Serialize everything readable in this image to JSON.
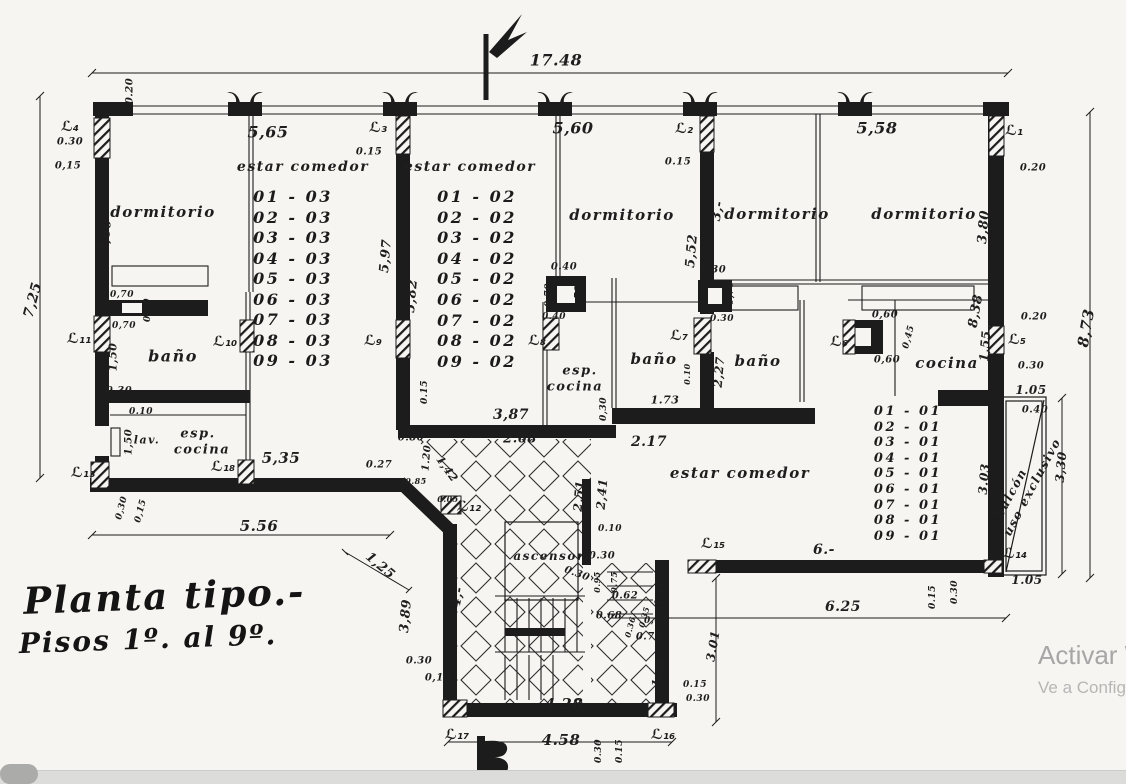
{
  "colors": {
    "ink": "#1c1c1c",
    "paper": "#f6f5f1",
    "watermark_line1": "#a6a6a6",
    "watermark_line2": "#b6b6b6",
    "strip": "#dcdcda",
    "pill": "#ababa9"
  },
  "title": {
    "line1": "Planta tipo.-",
    "line2": "Pisos 1º. al 9º."
  },
  "watermark": {
    "line1": "Activar W",
    "line2": "Ve a Config"
  },
  "unit_lists": [
    {
      "n": "unit-list-apt3",
      "x": 293,
      "top": 187,
      "lh": 20.5,
      "s": 16,
      "items": [
        "01 - 03",
        "02 - 03",
        "03 - 03",
        "04 - 03",
        "05 - 03",
        "06 - 03",
        "07 - 03",
        "08 - 03",
        "09 - 03"
      ]
    },
    {
      "n": "unit-list-apt2",
      "x": 477,
      "top": 187,
      "lh": 20.6,
      "s": 16,
      "items": [
        "01 - 02",
        "02 - 02",
        "03 - 02",
        "04 - 02",
        "05 - 02",
        "06 - 02",
        "07 - 02",
        "08 - 02",
        "09 - 02"
      ]
    },
    {
      "n": "unit-list-apt1",
      "x": 908,
      "top": 404,
      "lh": 15.6,
      "s": 13,
      "items": [
        "01 - 01",
        "02 - 01",
        "03 - 01",
        "04 - 01",
        "05 - 01",
        "06 - 01",
        "07 - 01",
        "08 - 01",
        "09 - 01"
      ]
    }
  ],
  "labels": [
    {
      "n": "room-dormitorio-apt3",
      "t": "dormitorio",
      "x": 163,
      "y": 212,
      "s": 15,
      "k": "room"
    },
    {
      "n": "room-estar-comedor-apt3",
      "t": "estar comedor",
      "x": 303,
      "y": 167,
      "s": 14,
      "k": "room"
    },
    {
      "n": "room-estar-comedor-apt2",
      "t": "estar comedor",
      "x": 470,
      "y": 167,
      "s": 14,
      "k": "room"
    },
    {
      "n": "room-dormitorio-apt2",
      "t": "dormitorio",
      "x": 622,
      "y": 215,
      "s": 15,
      "k": "room"
    },
    {
      "n": "room-dormitorio-apt1-a",
      "t": "dormitorio",
      "x": 777,
      "y": 214,
      "s": 15,
      "k": "room"
    },
    {
      "n": "room-dormitorio-apt1-b",
      "t": "dormitorio",
      "x": 924,
      "y": 214,
      "s": 15,
      "k": "room"
    },
    {
      "n": "room-bano-apt3",
      "t": "baño",
      "x": 173,
      "y": 356,
      "s": 16,
      "k": "room"
    },
    {
      "n": "room-bano-apt1-a",
      "t": "baño",
      "x": 654,
      "y": 359,
      "s": 15,
      "k": "room"
    },
    {
      "n": "room-bano-apt1-b",
      "t": "baño",
      "x": 758,
      "y": 361,
      "s": 15,
      "k": "room"
    },
    {
      "n": "room-cocina-apt1",
      "t": "cocina",
      "x": 947,
      "y": 363,
      "s": 15,
      "k": "room"
    },
    {
      "n": "room-esp-apt3",
      "t": "esp.",
      "x": 198,
      "y": 434,
      "s": 13,
      "k": "room"
    },
    {
      "n": "room-cocina-apt3",
      "t": "cocina",
      "x": 202,
      "y": 450,
      "s": 13,
      "k": "room"
    },
    {
      "n": "label-lav",
      "t": "lav.",
      "x": 147,
      "y": 440,
      "s": 11,
      "k": "room"
    },
    {
      "n": "room-esp-apt2",
      "t": "esp.",
      "x": 580,
      "y": 371,
      "s": 13,
      "k": "room"
    },
    {
      "n": "room-cocina-apt2",
      "t": "cocina",
      "x": 575,
      "y": 387,
      "s": 13,
      "k": "room"
    },
    {
      "n": "room-estar-comedor-apt1",
      "t": "estar comedor",
      "x": 740,
      "y": 473,
      "s": 15,
      "k": "room"
    },
    {
      "n": "room-ascensor",
      "t": "ascensor",
      "x": 549,
      "y": 556,
      "s": 12,
      "k": "room"
    },
    {
      "n": "room-balcon",
      "t": "balcón",
      "x": 1011,
      "y": 493,
      "s": 12,
      "k": "room",
      "r": -62
    },
    {
      "n": "room-uso-exclusivo",
      "t": "uso exclusivo",
      "x": 1032,
      "y": 487,
      "s": 12,
      "k": "room",
      "r": -62
    },
    {
      "n": "wall-label-l1",
      "t": "ℒ₁",
      "x": 1014,
      "y": 131,
      "s": 14,
      "k": "wall"
    },
    {
      "n": "wall-label-l2",
      "t": "ℒ₂",
      "x": 684,
      "y": 129,
      "s": 14,
      "k": "wall"
    },
    {
      "n": "wall-label-l3",
      "t": "ℒ₃",
      "x": 378,
      "y": 128,
      "s": 14,
      "k": "wall"
    },
    {
      "n": "wall-label-l4",
      "t": "ℒ₄",
      "x": 70,
      "y": 127,
      "s": 14,
      "k": "wall"
    },
    {
      "n": "wall-label-l5",
      "t": "ℒ₅",
      "x": 1017,
      "y": 340,
      "s": 14,
      "k": "wall"
    },
    {
      "n": "wall-label-l6",
      "t": "ℒ₆",
      "x": 839,
      "y": 342,
      "s": 14,
      "k": "wall"
    },
    {
      "n": "wall-label-l7",
      "t": "ℒ₇",
      "x": 679,
      "y": 336,
      "s": 14,
      "k": "wall"
    },
    {
      "n": "wall-label-l8",
      "t": "ℒ₈",
      "x": 537,
      "y": 341,
      "s": 14,
      "k": "wall"
    },
    {
      "n": "wall-label-l9",
      "t": "ℒ₉",
      "x": 373,
      "y": 341,
      "s": 14,
      "k": "wall"
    },
    {
      "n": "wall-label-l10",
      "t": "ℒ₁₀",
      "x": 225,
      "y": 342,
      "s": 14,
      "k": "wall"
    },
    {
      "n": "wall-label-l11",
      "t": "ℒ₁₁",
      "x": 79,
      "y": 339,
      "s": 14,
      "k": "wall"
    },
    {
      "n": "wall-label-l12",
      "t": "ℒ₁₂",
      "x": 469,
      "y": 507,
      "s": 14,
      "k": "wall"
    },
    {
      "n": "wall-label-l13",
      "t": "ℒ₁₃",
      "x": 83,
      "y": 473,
      "s": 14,
      "k": "wall"
    },
    {
      "n": "wall-label-l14",
      "t": "ℒ₁₄",
      "x": 1015,
      "y": 554,
      "s": 14,
      "k": "wall"
    },
    {
      "n": "wall-label-l15",
      "t": "ℒ₁₅",
      "x": 713,
      "y": 544,
      "s": 14,
      "k": "wall"
    },
    {
      "n": "wall-label-l16",
      "t": "ℒ₁₆",
      "x": 663,
      "y": 735,
      "s": 14,
      "k": "wall"
    },
    {
      "n": "wall-label-l17",
      "t": "ℒ₁₇",
      "x": 457,
      "y": 735,
      "s": 14,
      "k": "wall"
    },
    {
      "n": "wall-label-l18",
      "t": "ℒ₁₈",
      "x": 223,
      "y": 467,
      "s": 14,
      "k": "wall"
    },
    {
      "n": "dim-total-width",
      "t": "17.48",
      "x": 556,
      "y": 60,
      "s": 16
    },
    {
      "n": "dim-5-65",
      "t": "5,65",
      "x": 268,
      "y": 132,
      "s": 16
    },
    {
      "n": "dim-5-60",
      "t": "5,60",
      "x": 573,
      "y": 128,
      "s": 16
    },
    {
      "n": "dim-5-58",
      "t": "5,58",
      "x": 877,
      "y": 128,
      "s": 16
    },
    {
      "n": "dim-7-25",
      "t": "7,25",
      "x": 33,
      "y": 300,
      "s": 14,
      "r": -75
    },
    {
      "n": "dim-8-73",
      "t": "8,73",
      "x": 1086,
      "y": 328,
      "s": 15,
      "r": -80
    },
    {
      "n": "dim-3-60",
      "t": "3,60",
      "x": 106,
      "y": 236,
      "s": 13,
      "r": -85
    },
    {
      "n": "dim-5-97",
      "t": "5,97",
      "x": 386,
      "y": 256,
      "s": 13,
      "r": -85
    },
    {
      "n": "dim-5-82",
      "t": "5,82",
      "x": 412,
      "y": 296,
      "s": 13,
      "r": -85
    },
    {
      "n": "dim-5-52",
      "t": "5,52",
      "x": 692,
      "y": 251,
      "s": 13,
      "r": -85
    },
    {
      "n": "dim-3-dash",
      "t": "3,-",
      "x": 718,
      "y": 211,
      "s": 13,
      "r": -80
    },
    {
      "n": "dim-3-80",
      "t": "3,80",
      "x": 984,
      "y": 227,
      "s": 13,
      "r": -85
    },
    {
      "n": "dim-8-38",
      "t": "8,38",
      "x": 976,
      "y": 311,
      "s": 13,
      "r": -80
    },
    {
      "n": "dim-1-55",
      "t": "1,55",
      "x": 985,
      "y": 346,
      "s": 12,
      "r": -85
    },
    {
      "n": "dim-0-20-a",
      "t": "0.20",
      "x": 130,
      "y": 91,
      "s": 10,
      "r": -90
    },
    {
      "n": "dim-0-20-b",
      "t": "0.20",
      "x": 1033,
      "y": 168,
      "s": 10
    },
    {
      "n": "dim-0-20-c",
      "t": "0.20",
      "x": 1034,
      "y": 317,
      "s": 10
    },
    {
      "n": "dim-0-30-a",
      "t": "0.30",
      "x": 70,
      "y": 142,
      "s": 10
    },
    {
      "n": "dim-0-15-a",
      "t": "0,15",
      "x": 68,
      "y": 166,
      "s": 10
    },
    {
      "n": "dim-0-15-b",
      "t": "0.15",
      "x": 369,
      "y": 152,
      "s": 10
    },
    {
      "n": "dim-0-15-c",
      "t": "0.15",
      "x": 678,
      "y": 162,
      "s": 10
    },
    {
      "n": "dim-0-40-a",
      "t": "0.40",
      "x": 564,
      "y": 267,
      "s": 10
    },
    {
      "n": "dim-0-70-a",
      "t": "0,70",
      "x": 549,
      "y": 295,
      "s": 9,
      "r": -90
    },
    {
      "n": "dim-0-70-b",
      "t": "0,70",
      "x": 579,
      "y": 297,
      "s": 9,
      "r": -90
    },
    {
      "n": "dim-0-30-b",
      "t": "0.30",
      "x": 713,
      "y": 270,
      "s": 10
    },
    {
      "n": "dim-0-70-c",
      "t": "0,70",
      "x": 731,
      "y": 293,
      "s": 9,
      "r": -90
    },
    {
      "n": "dim-0-70-d",
      "t": "0,70",
      "x": 122,
      "y": 295,
      "s": 9
    },
    {
      "n": "dim-0-70-e",
      "t": "0,70",
      "x": 124,
      "y": 326,
      "s": 9
    },
    {
      "n": "dim-0-30-c",
      "t": "0.30",
      "x": 148,
      "y": 310,
      "s": 9,
      "r": -90
    },
    {
      "n": "dim-1-50-a",
      "t": "1,50",
      "x": 113,
      "y": 357,
      "s": 11,
      "r": -90
    },
    {
      "n": "dim-0-30-d",
      "t": "0.30",
      "x": 119,
      "y": 391,
      "s": 10
    },
    {
      "n": "dim-0-10-a",
      "t": "0.10",
      "x": 141,
      "y": 412,
      "s": 9
    },
    {
      "n": "dim-1-50-b",
      "t": "1,50",
      "x": 129,
      "y": 442,
      "s": 10,
      "r": -90
    },
    {
      "n": "dim-5-35",
      "t": "5,35",
      "x": 281,
      "y": 458,
      "s": 15
    },
    {
      "n": "dim-0-27",
      "t": "0.27",
      "x": 379,
      "y": 465,
      "s": 10
    },
    {
      "n": "dim-0-30-e",
      "t": "0,30",
      "x": 122,
      "y": 508,
      "s": 9,
      "r": -75
    },
    {
      "n": "dim-0-15-d",
      "t": "0,15",
      "x": 141,
      "y": 511,
      "s": 9,
      "r": -75
    },
    {
      "n": "dim-5-56",
      "t": "5.56",
      "x": 259,
      "y": 526,
      "s": 15
    },
    {
      "n": "dim-1-25",
      "t": "1,25",
      "x": 380,
      "y": 566,
      "s": 13,
      "r": 40
    },
    {
      "n": "dim-3-89",
      "t": "3,89",
      "x": 406,
      "y": 616,
      "s": 13,
      "r": -85
    },
    {
      "n": "dim-0-80",
      "t": "0.80",
      "x": 411,
      "y": 438,
      "s": 10
    },
    {
      "n": "dim-1-20",
      "t": "1.20",
      "x": 427,
      "y": 458,
      "s": 10,
      "r": -85
    },
    {
      "n": "dim-1-42",
      "t": "1,42",
      "x": 447,
      "y": 469,
      "s": 11,
      "r": 55
    },
    {
      "n": "dim-0-85",
      "t": "0.85",
      "x": 416,
      "y": 481,
      "s": 8
    },
    {
      "n": "dim-0-05",
      "t": "0.05",
      "x": 448,
      "y": 499,
      "s": 8
    },
    {
      "n": "dim-0-15-e",
      "t": "0.15",
      "x": 425,
      "y": 392,
      "s": 9,
      "r": -90
    },
    {
      "n": "dim-3-87",
      "t": "3,87",
      "x": 511,
      "y": 415,
      "s": 14
    },
    {
      "n": "dim-2-68",
      "t": "2.68",
      "x": 520,
      "y": 439,
      "s": 13
    },
    {
      "n": "dim-0-40-b",
      "t": "0.40",
      "x": 554,
      "y": 317,
      "s": 9
    },
    {
      "n": "dim-0-30-f",
      "t": "0,30",
      "x": 604,
      "y": 409,
      "s": 9,
      "r": -90
    },
    {
      "n": "dim-1-73",
      "t": "1.73",
      "x": 665,
      "y": 400,
      "s": 11
    },
    {
      "n": "dim-0-10-b",
      "t": "0.10",
      "x": 687,
      "y": 374,
      "s": 8,
      "r": -90
    },
    {
      "n": "dim-2-17",
      "t": "2.17",
      "x": 649,
      "y": 442,
      "s": 14
    },
    {
      "n": "dim-2-27",
      "t": "2,27",
      "x": 719,
      "y": 372,
      "s": 12,
      "r": -85
    },
    {
      "n": "dim-0-30-g",
      "t": "0.30",
      "x": 722,
      "y": 319,
      "s": 9
    },
    {
      "n": "dim-0-60-a",
      "t": "0,60",
      "x": 885,
      "y": 315,
      "s": 10
    },
    {
      "n": "dim-0-60-b",
      "t": "0,60",
      "x": 887,
      "y": 360,
      "s": 10
    },
    {
      "n": "dim-0-45",
      "t": "0,45",
      "x": 909,
      "y": 337,
      "s": 9,
      "r": -75
    },
    {
      "n": "dim-1-05-a",
      "t": "1.05",
      "x": 1031,
      "y": 390,
      "s": 12
    },
    {
      "n": "dim-0-40-c",
      "t": "0.40",
      "x": 1035,
      "y": 410,
      "s": 10
    },
    {
      "n": "dim-0-30-h",
      "t": "0.30",
      "x": 1031,
      "y": 366,
      "s": 10
    },
    {
      "n": "dim-3-03",
      "t": "3.03",
      "x": 984,
      "y": 479,
      "s": 12,
      "r": -85
    },
    {
      "n": "dim-3-30",
      "t": "3,30",
      "x": 1061,
      "y": 467,
      "s": 12,
      "r": -85
    },
    {
      "n": "dim-1-05-b",
      "t": "1.05",
      "x": 1027,
      "y": 580,
      "s": 12
    },
    {
      "n": "dim-6-dash",
      "t": "6.-",
      "x": 824,
      "y": 550,
      "s": 14
    },
    {
      "n": "dim-6-25",
      "t": "6.25",
      "x": 843,
      "y": 607,
      "s": 14
    },
    {
      "n": "dim-0-15-f",
      "t": "0.15",
      "x": 933,
      "y": 597,
      "s": 9,
      "r": -90
    },
    {
      "n": "dim-0-30-i",
      "t": "0.30",
      "x": 955,
      "y": 592,
      "s": 9,
      "r": -90
    },
    {
      "n": "dim-1-10",
      "t": "1.10",
      "x": 660,
      "y": 593,
      "s": 10,
      "r": -85
    },
    {
      "n": "dim-0-62",
      "t": "0.62",
      "x": 625,
      "y": 596,
      "s": 10
    },
    {
      "n": "dim-0-68",
      "t": "0.68",
      "x": 609,
      "y": 616,
      "s": 10
    },
    {
      "n": "dim-0-65",
      "t": "0,65",
      "x": 656,
      "y": 621,
      "s": 9
    },
    {
      "n": "dim-0-73",
      "t": "0.73",
      "x": 649,
      "y": 637,
      "s": 10
    },
    {
      "n": "dim-0-35",
      "t": "0.35",
      "x": 644,
      "y": 617,
      "s": 8,
      "r": -75
    },
    {
      "n": "dim-0-36",
      "t": "0.36",
      "x": 630,
      "y": 627,
      "s": 8,
      "r": -75
    },
    {
      "n": "dim-0-30-j",
      "t": "0.30",
      "x": 602,
      "y": 556,
      "s": 10
    },
    {
      "n": "dim-0-30-k",
      "t": "0.30",
      "x": 577,
      "y": 574,
      "s": 10,
      "r": 20
    },
    {
      "n": "dim-0-95",
      "t": "0.95",
      "x": 597,
      "y": 582,
      "s": 8,
      "r": -90
    },
    {
      "n": "dim-0-75",
      "t": "0.75",
      "x": 614,
      "y": 582,
      "s": 8,
      "r": -90
    },
    {
      "n": "dim-0-10-c",
      "t": "0.10",
      "x": 610,
      "y": 529,
      "s": 9
    },
    {
      "n": "dim-2-51",
      "t": "2,51",
      "x": 579,
      "y": 496,
      "s": 12,
      "r": -85
    },
    {
      "n": "dim-2-41",
      "t": "2,41",
      "x": 602,
      "y": 494,
      "s": 12,
      "r": -85
    },
    {
      "n": "dim-4-dash",
      "t": "4,-",
      "x": 458,
      "y": 597,
      "s": 13,
      "r": -80
    },
    {
      "n": "dim-0-30-l",
      "t": "0.30",
      "x": 419,
      "y": 661,
      "s": 10
    },
    {
      "n": "dim-0-15-g",
      "t": "0,15",
      "x": 438,
      "y": 678,
      "s": 10
    },
    {
      "n": "dim-1-81",
      "t": "1,81",
      "x": 659,
      "y": 673,
      "s": 11,
      "r": -75
    },
    {
      "n": "dim-0-15-h",
      "t": "0.15",
      "x": 695,
      "y": 685,
      "s": 9
    },
    {
      "n": "dim-0-30-m",
      "t": "0.30",
      "x": 698,
      "y": 699,
      "s": 9
    },
    {
      "n": "dim-4-28",
      "t": "4,28",
      "x": 564,
      "y": 704,
      "s": 15
    },
    {
      "n": "dim-4-58",
      "t": "4.58",
      "x": 561,
      "y": 740,
      "s": 15
    },
    {
      "n": "dim-0-30-n",
      "t": "0.30",
      "x": 599,
      "y": 751,
      "s": 9,
      "r": -90
    },
    {
      "n": "dim-0-15-i",
      "t": "0.15",
      "x": 620,
      "y": 751,
      "s": 9,
      "r": -90
    },
    {
      "n": "dim-3-01",
      "t": "3.01",
      "x": 713,
      "y": 646,
      "s": 12,
      "r": -80
    }
  ]
}
